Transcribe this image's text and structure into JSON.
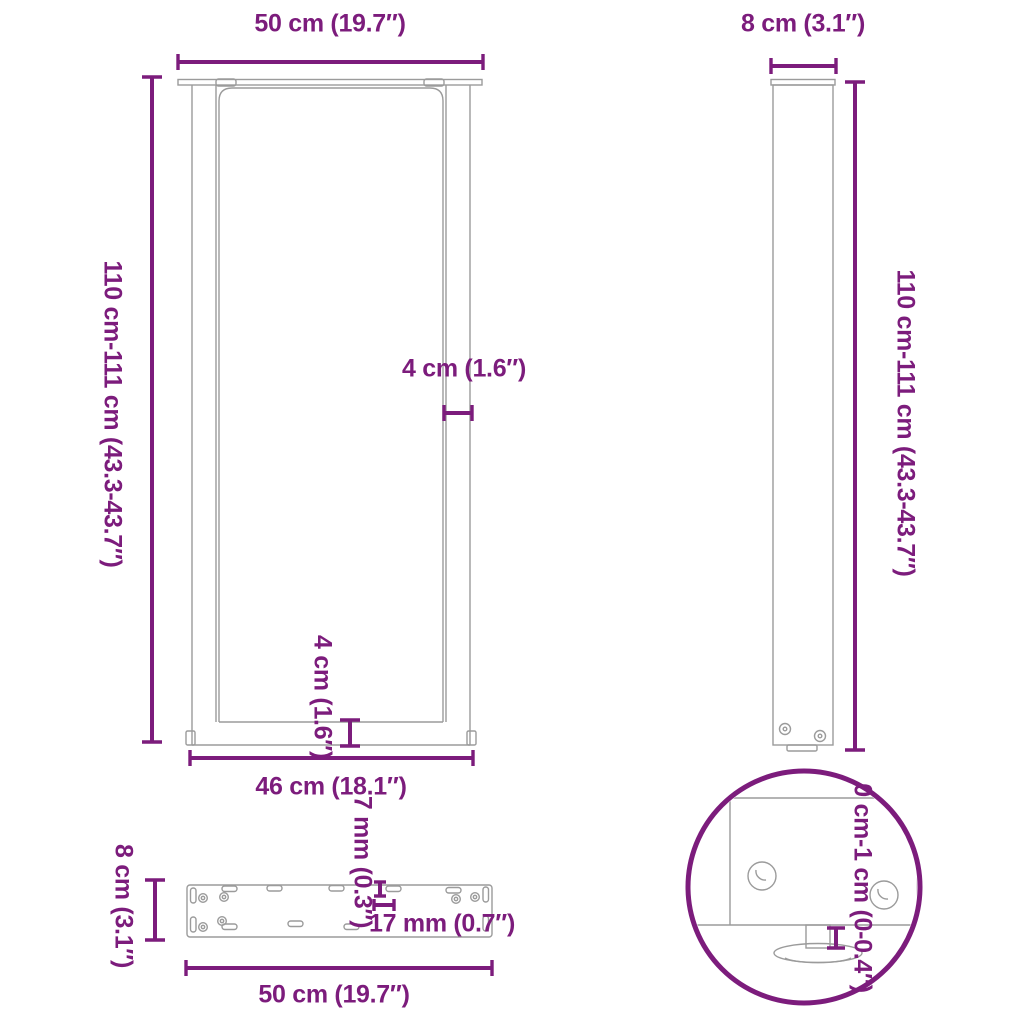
{
  "image_type": "product-dimension-diagram",
  "subject": "U-shaped coffee table legs with mounting plate and adjustable feet",
  "colors": {
    "accent": "#7c1c7c",
    "gray": "#9b9b9b",
    "bg": "#ffffff"
  },
  "labels": {
    "front_width_top": "50 cm (19.7″)",
    "front_height_left": "110 cm-111 cm (43.3-43.7″)",
    "front_tube_width": "4 cm (1.6″)",
    "front_crossbar_height": "4 cm (1.6″)",
    "front_inner_width": "46 cm (18.1″)",
    "side_width_top": "8 cm (3.1″)",
    "side_height_right": "110 cm-111 cm (43.3-43.7″)",
    "plate_depth_left": "8 cm (3.1″)",
    "plate_hole_offset_vertical": "7 mm (0.3″)",
    "plate_hole_offset_horizontal": "17 mm (0.7″)",
    "plate_width_bottom": "50 cm (19.7″)",
    "foot_adjust_range": "0 cm-1 cm (0-0.4″)"
  }
}
